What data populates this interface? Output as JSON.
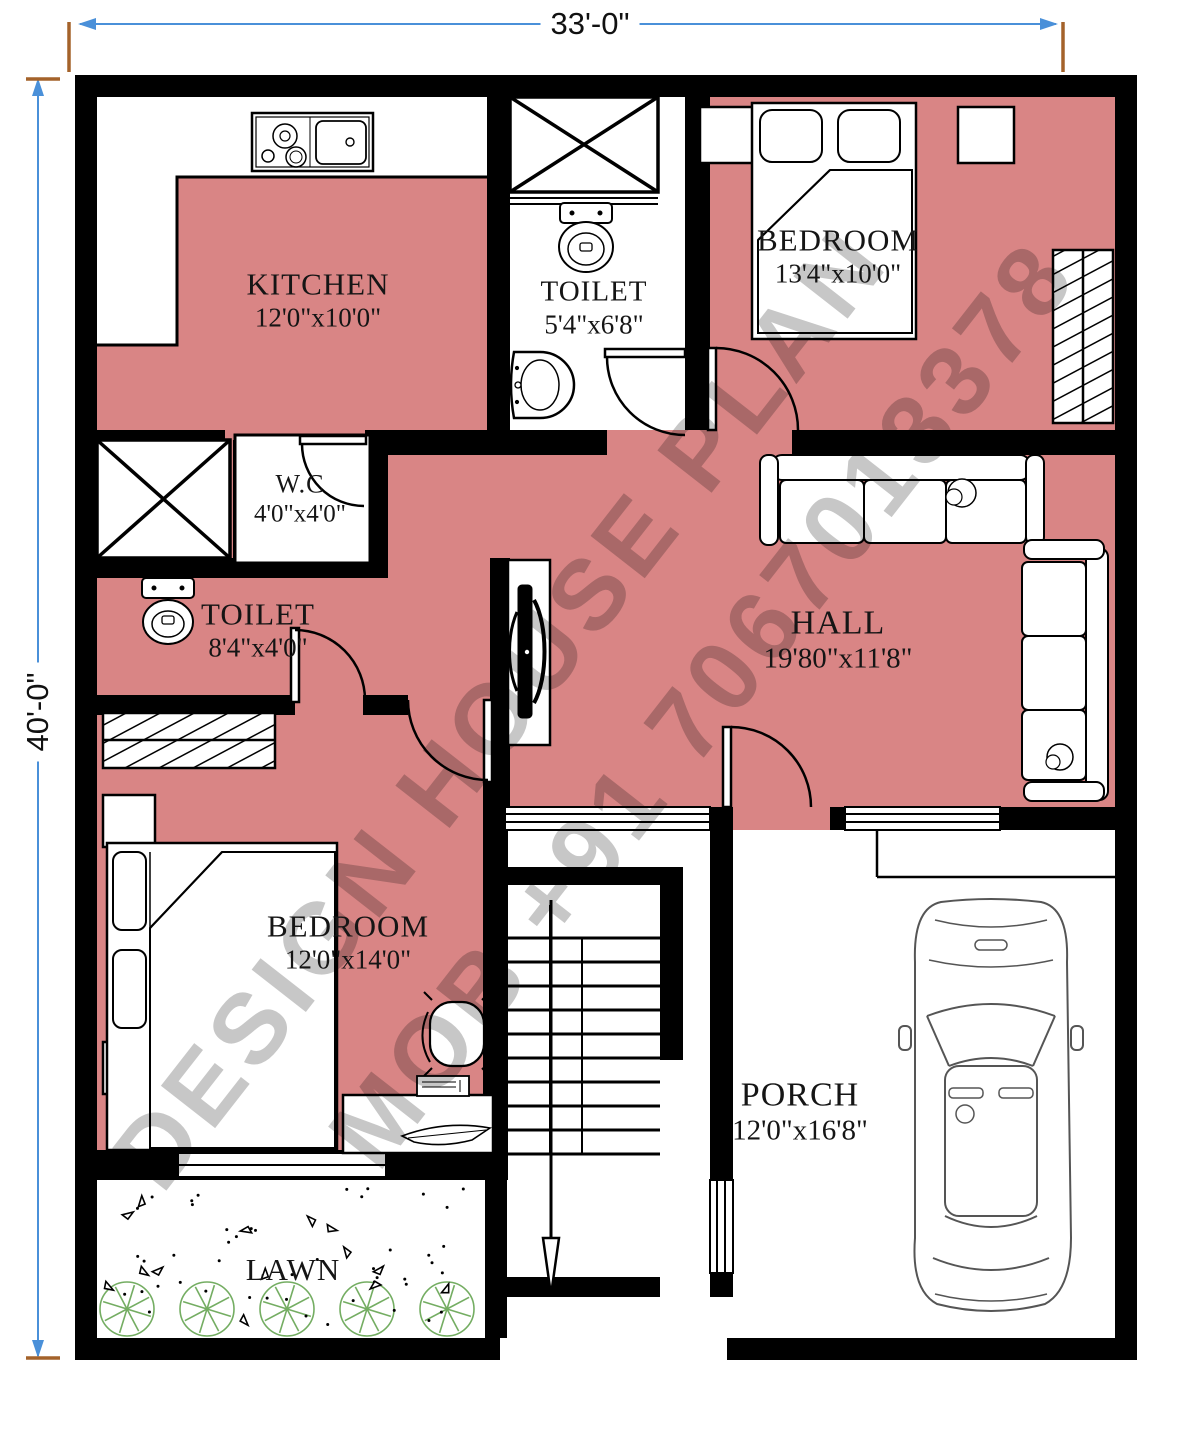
{
  "plan": {
    "overall_width": "33'-0\"",
    "overall_height": "40'-0\"",
    "watermark_line1": "DESIGN HOUSE PLAN",
    "watermark_line2": "MOB +91 7067013378"
  },
  "rooms": {
    "kitchen": {
      "name": "KITCHEN",
      "size": "12'0\"x10'0\""
    },
    "toilet_top": {
      "name": "TOILET",
      "size": "5'4\"x6'8\""
    },
    "bedroom_top": {
      "name": "BEDROOM",
      "size": "13'4\"x10'0\""
    },
    "wc": {
      "name": "W.C",
      "size": "4'0\"x4'0\""
    },
    "toilet_left": {
      "name": "TOILET",
      "size": "8'4\"x4'0\""
    },
    "hall": {
      "name": "HALL",
      "size": "19'80\"x11'8\""
    },
    "bedroom_bottom": {
      "name": "BEDROOM",
      "size": "12'0\"x14'0\""
    },
    "porch": {
      "name": "PORCH",
      "size": "12'0\"x16'8\""
    },
    "lawn": {
      "name": "LAWN"
    }
  },
  "colors": {
    "floor": "#D98585",
    "wall": "#000000",
    "dimension_line": "#4a90d9",
    "extension_tick": "#a4622a",
    "tree": "#74ad62",
    "watermark": "#8f8f8f"
  }
}
